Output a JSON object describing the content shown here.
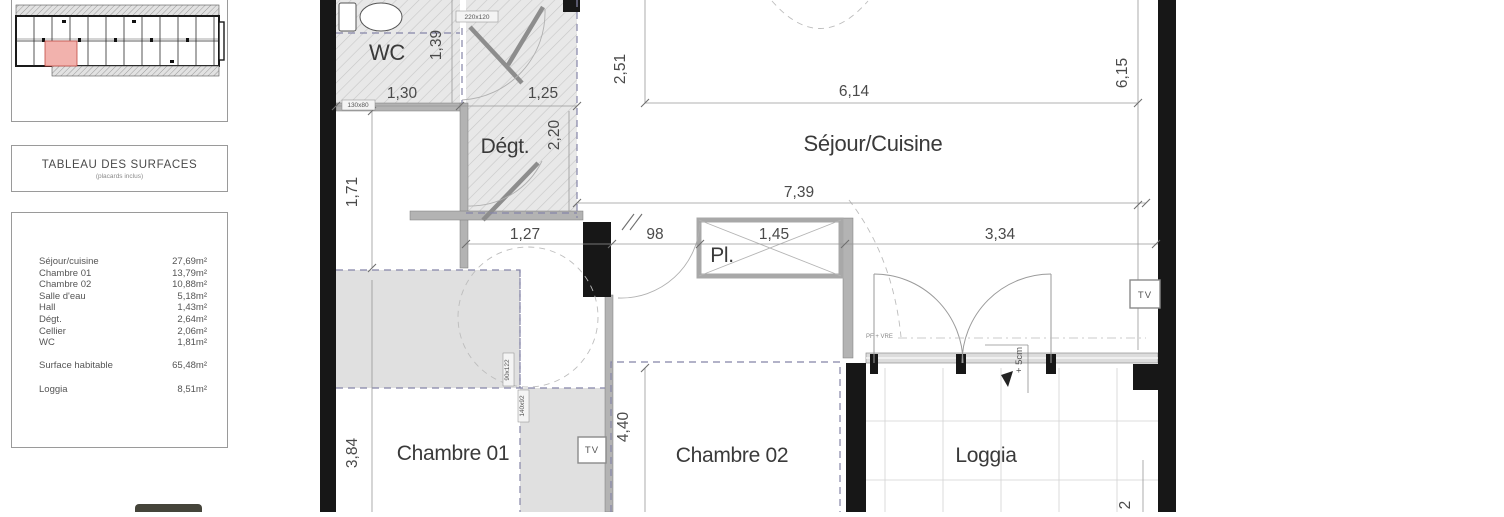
{
  "left_panel": {
    "surfaces_title": "TABLEAU DES SURFACES",
    "surfaces_subtitle": "(placards inclus)",
    "rows": [
      {
        "label": "Séjour/cuisine",
        "area": "27,69m²"
      },
      {
        "label": "Chambre 01",
        "area": "13,79m²"
      },
      {
        "label": "Chambre 02",
        "area": "10,88m²"
      },
      {
        "label": "Salle d'eau",
        "area": "5,18m²"
      },
      {
        "label": "Hall",
        "area": "1,43m²"
      },
      {
        "label": "Dégt.",
        "area": "2,64m²"
      },
      {
        "label": "Cellier",
        "area": "2,06m²"
      },
      {
        "label": "WC",
        "area": "1,81m²"
      }
    ],
    "total_row": {
      "label": "Surface habitable",
      "area": "65,48m²"
    },
    "loggia_row": {
      "label": "Loggia",
      "area": "8,51m²"
    },
    "highlight_color": "#f2b2ad"
  },
  "plan": {
    "rooms": {
      "wc": "WC",
      "degt": "Dégt.",
      "sejour": "Séjour/Cuisine",
      "pl": "Pl.",
      "c01": "Chambre 01",
      "c02": "Chambre 02",
      "loggia": "Loggia"
    },
    "dims": {
      "d130": "1,30",
      "d139": "1,39",
      "d125": "1,25",
      "d220": "2,20",
      "d251": "2,51",
      "d614": "6,14",
      "d615": "6,15",
      "d171": "1,71",
      "d739": "7,39",
      "d127": "1,27",
      "d98": "98",
      "d145": "1,45",
      "d334": "3,34",
      "d384": "3,84",
      "d440": "4,40",
      "dcut": "2"
    },
    "tags": {
      "t220": "220x120",
      "t130": "130x80",
      "t90": "90x122",
      "t140": "140x92",
      "pf": "PF + VRE",
      "plus5": "+ 5cm",
      "tv": "TV"
    },
    "colors": {
      "wall": "#171717",
      "dash": "#8585a8",
      "hatch": "#e8e8e8"
    }
  }
}
